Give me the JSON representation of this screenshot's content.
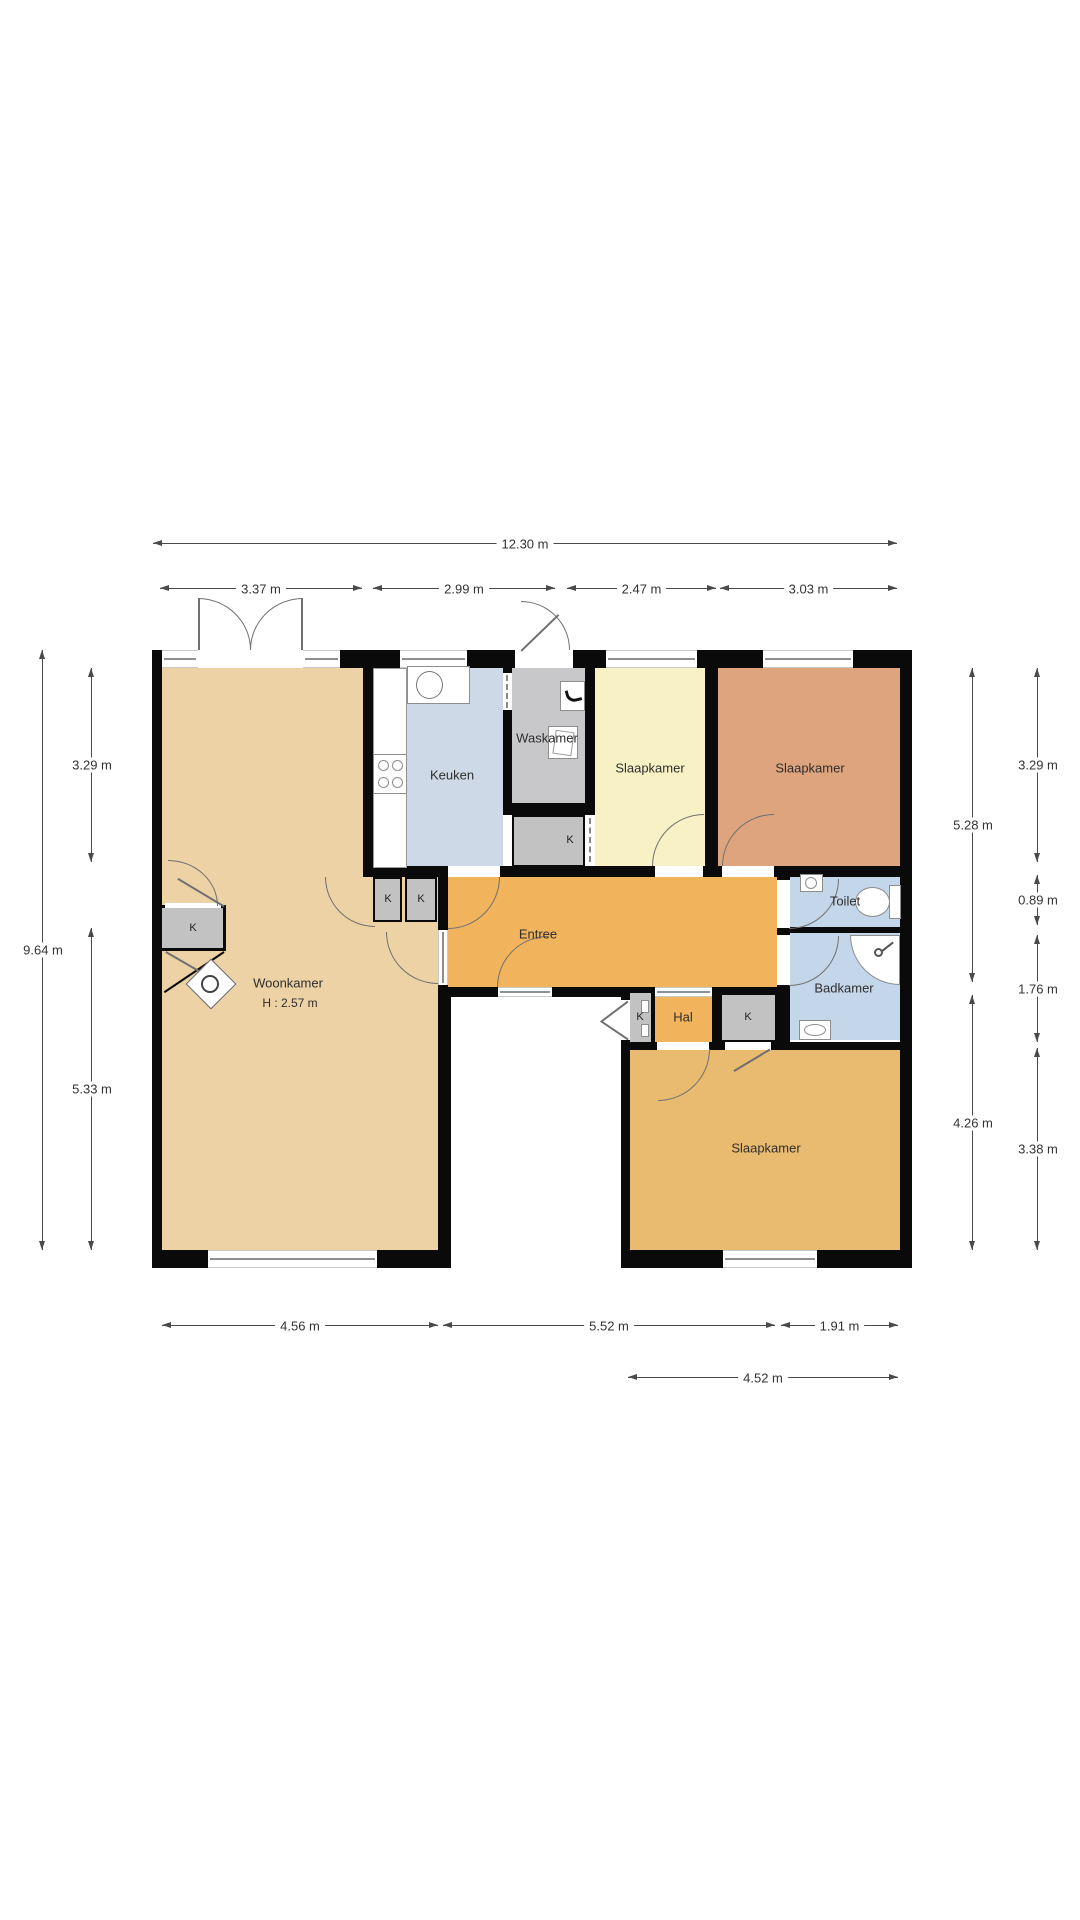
{
  "floorplan": {
    "rooms": {
      "woonkamer": {
        "label": "Woonkamer",
        "height_note": "H : 2.57 m"
      },
      "keuken": {
        "label": "Keuken"
      },
      "waskamer": {
        "label": "Waskamer"
      },
      "slaapkamer_mid": {
        "label": "Slaapkamer"
      },
      "slaapkamer_right": {
        "label": "Slaapkamer"
      },
      "slaapkamer_bottom": {
        "label": "Slaapkamer"
      },
      "entree": {
        "label": "Entree"
      },
      "hal": {
        "label": "Hal"
      },
      "toilet": {
        "label": "Toilet"
      },
      "badkamer": {
        "label": "Badkamer"
      }
    },
    "closet_label": "K",
    "dimensions": {
      "overall_width": "12.30 m",
      "top_segments": [
        "3.37 m",
        "2.99 m",
        "2.47 m",
        "3.03 m"
      ],
      "left": {
        "overall": "9.64 m",
        "top": "3.29 m",
        "bottom": "5.33 m"
      },
      "right": {
        "inner_top": "5.28 m",
        "inner_bottom": "4.26 m",
        "outer_top": "3.29 m",
        "outer_mid1": "0.89 m",
        "outer_mid2": "1.76 m",
        "outer_bottom": "3.38 m"
      },
      "bottom_segments": [
        "4.56 m",
        "5.52 m",
        "1.91 m"
      ],
      "bottom_overall": "4.52 m"
    },
    "colors": {
      "woonkamer": "#ecd2a5",
      "keuken": "#cdd9e6",
      "waskamer": "#c8c8ca",
      "slaapkamer_mid": "#f7f1c5",
      "slaapkamer_right": "#dda47d",
      "slaapkamer_bottom": "#e8bb70",
      "entree": "#f1b45d",
      "bathroom": "#c4d6e9",
      "closet": "#c2c2c2",
      "wall": "#0a0a0a"
    }
  }
}
